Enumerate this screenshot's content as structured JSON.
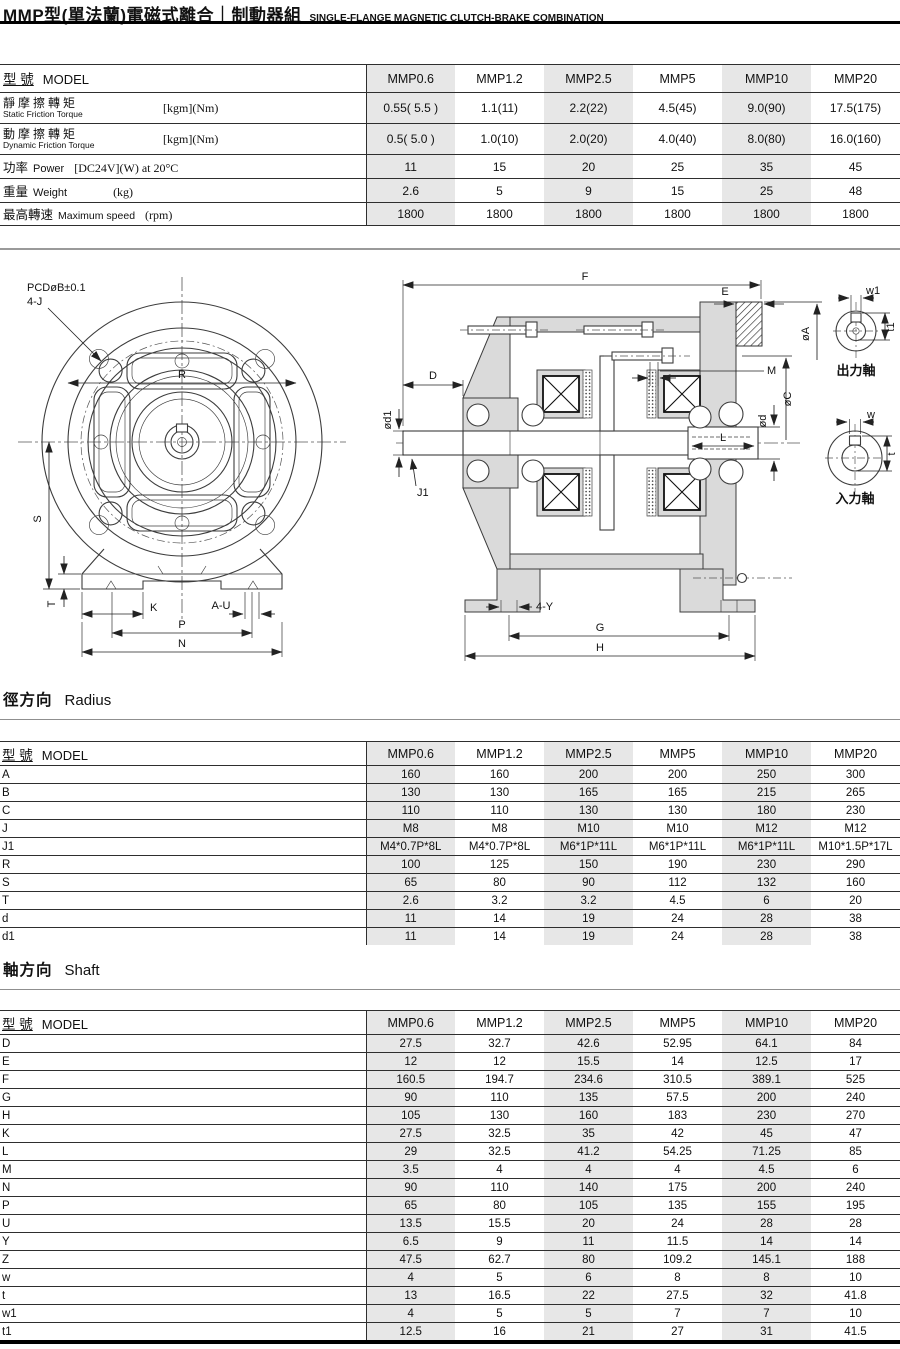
{
  "title": {
    "zh": "MMP型(單法蘭)電磁式離合｜制動器組",
    "en": "SINGLE-FLANGE MAGNETIC CLUTCH-BRAKE COMBINATION"
  },
  "models": [
    "MMP0.6",
    "MMP1.2",
    "MMP2.5",
    "MMP5",
    "MMP10",
    "MMP20"
  ],
  "spec_table": {
    "model_header_zh": "型 號",
    "model_header_en": "MODEL",
    "rows": [
      {
        "label_zh": "靜摩擦轉矩",
        "label_en": "Static Friction Torque",
        "unit": "[kgm](Nm)",
        "values": [
          "0.55( 5.5 )",
          "1.1(11)",
          "2.2(22)",
          "4.5(45)",
          "9.0(90)",
          "17.5(175)"
        ]
      },
      {
        "label_zh": "動摩擦轉矩",
        "label_en": "Dynamic Friction Torque",
        "unit": "[kgm](Nm)",
        "values": [
          "0.5( 5.0 )",
          "1.0(10)",
          "2.0(20)",
          "4.0(40)",
          "8.0(80)",
          "16.0(160)"
        ]
      },
      {
        "label_zh": "功率",
        "label_en": "Power",
        "unit": "[DC24V](W) at 20°C",
        "values": [
          "11",
          "15",
          "20",
          "25",
          "35",
          "45"
        ]
      },
      {
        "label_zh": "重量",
        "label_en": "Weight",
        "unit": "(kg)",
        "values": [
          "2.6",
          "5",
          "9",
          "15",
          "25",
          "48"
        ]
      },
      {
        "label_zh": "最高轉速",
        "label_en": "Maximum speed",
        "unit": "(rpm)",
        "values": [
          "1800",
          "1800",
          "1800",
          "1800",
          "1800",
          "1800"
        ]
      }
    ]
  },
  "radius_section": {
    "heading_zh": "徑方向",
    "heading_en": "Radius",
    "model_header_zh": "型 號",
    "model_header_en": "MODEL",
    "rows": [
      {
        "label": "A",
        "values": [
          "160",
          "160",
          "200",
          "200",
          "250",
          "300"
        ]
      },
      {
        "label": "B",
        "values": [
          "130",
          "130",
          "165",
          "165",
          "215",
          "265"
        ]
      },
      {
        "label": "C",
        "values": [
          "110",
          "110",
          "130",
          "130",
          "180",
          "230"
        ]
      },
      {
        "label": "J",
        "values": [
          "M8",
          "M8",
          "M10",
          "M10",
          "M12",
          "M12"
        ]
      },
      {
        "label": "J1",
        "values": [
          "M4*0.7P*8L",
          "M4*0.7P*8L",
          "M6*1P*11L",
          "M6*1P*11L",
          "M6*1P*11L",
          "M10*1.5P*17L"
        ]
      },
      {
        "label": "R",
        "values": [
          "100",
          "125",
          "150",
          "190",
          "230",
          "290"
        ]
      },
      {
        "label": "S",
        "values": [
          "65",
          "80",
          "90",
          "112",
          "132",
          "160"
        ]
      },
      {
        "label": "T",
        "values": [
          "2.6",
          "3.2",
          "3.2",
          "4.5",
          "6",
          "20"
        ]
      },
      {
        "label": "d",
        "values": [
          "11",
          "14",
          "19",
          "24",
          "28",
          "38"
        ]
      },
      {
        "label": "d1",
        "values": [
          "11",
          "14",
          "19",
          "24",
          "28",
          "38"
        ]
      }
    ]
  },
  "shaft_section": {
    "heading_zh": "軸方向",
    "heading_en": "Shaft",
    "model_header_zh": "型 號",
    "model_header_en": "MODEL",
    "rows": [
      {
        "label": "D",
        "values": [
          "27.5",
          "32.7",
          "42.6",
          "52.95",
          "64.1",
          "84"
        ]
      },
      {
        "label": "E",
        "values": [
          "12",
          "12",
          "15.5",
          "14",
          "12.5",
          "17"
        ]
      },
      {
        "label": "F",
        "values": [
          "160.5",
          "194.7",
          "234.6",
          "310.5",
          "389.1",
          "525"
        ]
      },
      {
        "label": "G",
        "values": [
          "90",
          "110",
          "135",
          "57.5",
          "200",
          "240"
        ]
      },
      {
        "label": "H",
        "values": [
          "105",
          "130",
          "160",
          "183",
          "230",
          "270"
        ]
      },
      {
        "label": "K",
        "values": [
          "27.5",
          "32.5",
          "35",
          "42",
          "45",
          "47"
        ]
      },
      {
        "label": "L",
        "values": [
          "29",
          "32.5",
          "41.2",
          "54.25",
          "71.25",
          "85"
        ]
      },
      {
        "label": "M",
        "values": [
          "3.5",
          "4",
          "4",
          "4",
          "4.5",
          "6"
        ]
      },
      {
        "label": "N",
        "values": [
          "90",
          "110",
          "140",
          "175",
          "200",
          "240"
        ]
      },
      {
        "label": "P",
        "values": [
          "65",
          "80",
          "105",
          "135",
          "155",
          "195"
        ]
      },
      {
        "label": "U",
        "values": [
          "13.5",
          "15.5",
          "20",
          "24",
          "28",
          "28"
        ]
      },
      {
        "label": "Y",
        "values": [
          "6.5",
          "9",
          "11",
          "11.5",
          "14",
          "14"
        ]
      },
      {
        "label": "Z",
        "values": [
          "47.5",
          "62.7",
          "80",
          "109.2",
          "145.1",
          "188"
        ]
      },
      {
        "label": "w",
        "values": [
          "4",
          "5",
          "6",
          "8",
          "8",
          "10"
        ]
      },
      {
        "label": "t",
        "values": [
          "13",
          "16.5",
          "22",
          "27.5",
          "32",
          "41.8"
        ]
      },
      {
        "label": "w1",
        "values": [
          "4",
          "5",
          "5",
          "7",
          "7",
          "10"
        ]
      },
      {
        "label": "t1",
        "values": [
          "12.5",
          "16",
          "21",
          "27",
          "31",
          "41.5"
        ]
      }
    ]
  },
  "drawing": {
    "front_view": {
      "pcd_label": "PCDøB±0.1",
      "bolt_label": "4-J",
      "dims": {
        "r": "R",
        "s": "S",
        "t": "T",
        "k": "K",
        "au": "A-U",
        "p": "P",
        "n": "N"
      }
    },
    "section_view": {
      "dims": {
        "f": "F",
        "e": "E",
        "d": "D",
        "od1": "ød1",
        "j1": "J1",
        "oa": "øA",
        "m": "M",
        "oc": "øC",
        "od": "ød",
        "l": "L",
        "y4": "4-Y",
        "g": "G",
        "h": "H"
      }
    },
    "end_views": {
      "output": {
        "caption": "出力軸",
        "w": "w1",
        "t": "t1"
      },
      "input": {
        "caption": "入力軸",
        "w": "w",
        "t": "t"
      }
    }
  },
  "colors": {
    "accent_shading": "#e7e7e7",
    "rule_gray": "#9a9a9a",
    "rule_black": "#000000"
  }
}
